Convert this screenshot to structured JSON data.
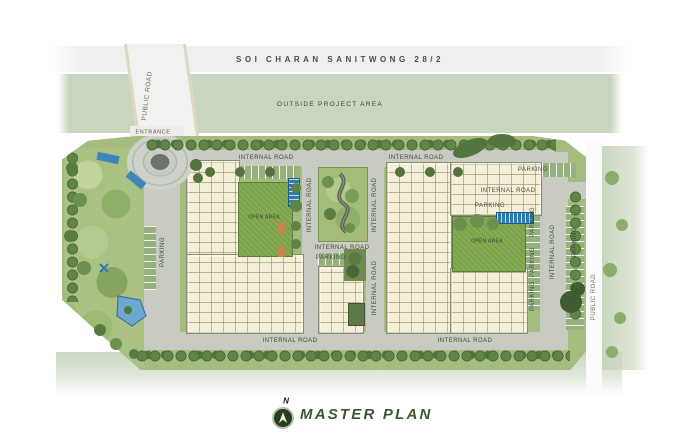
{
  "header_road": {
    "label": "SOI CHARAN SANITWONG 28/2"
  },
  "outside_area": {
    "label": "OUTSIDE PROJECT AREA"
  },
  "entry": {
    "public_road": "PUBLIC ROAD",
    "entrance": "ENTRANCE"
  },
  "road_labels": {
    "internal_road": "INTERNAL ROAD",
    "parking": "PARKING",
    "public_road": "PUBLIC ROAD"
  },
  "site": {
    "open_area": "OPEN AREA"
  },
  "legend": {
    "north": "N",
    "title": "MASTER PLAN"
  },
  "colors": {
    "outside_green": "#c8d6bf",
    "soi_road_gray": "#efefef",
    "internal_road_gray": "#c7cbc2",
    "site_green": "#a4bd7f",
    "building_cream": "#f6efd8",
    "lawn_green": "#7fa74d",
    "water_blue": "#2e7cb0",
    "hedge_green": "#4e6c3a",
    "stall_green": "#97b07f",
    "title_green": "#3a5731",
    "label_color": "#43493e"
  }
}
